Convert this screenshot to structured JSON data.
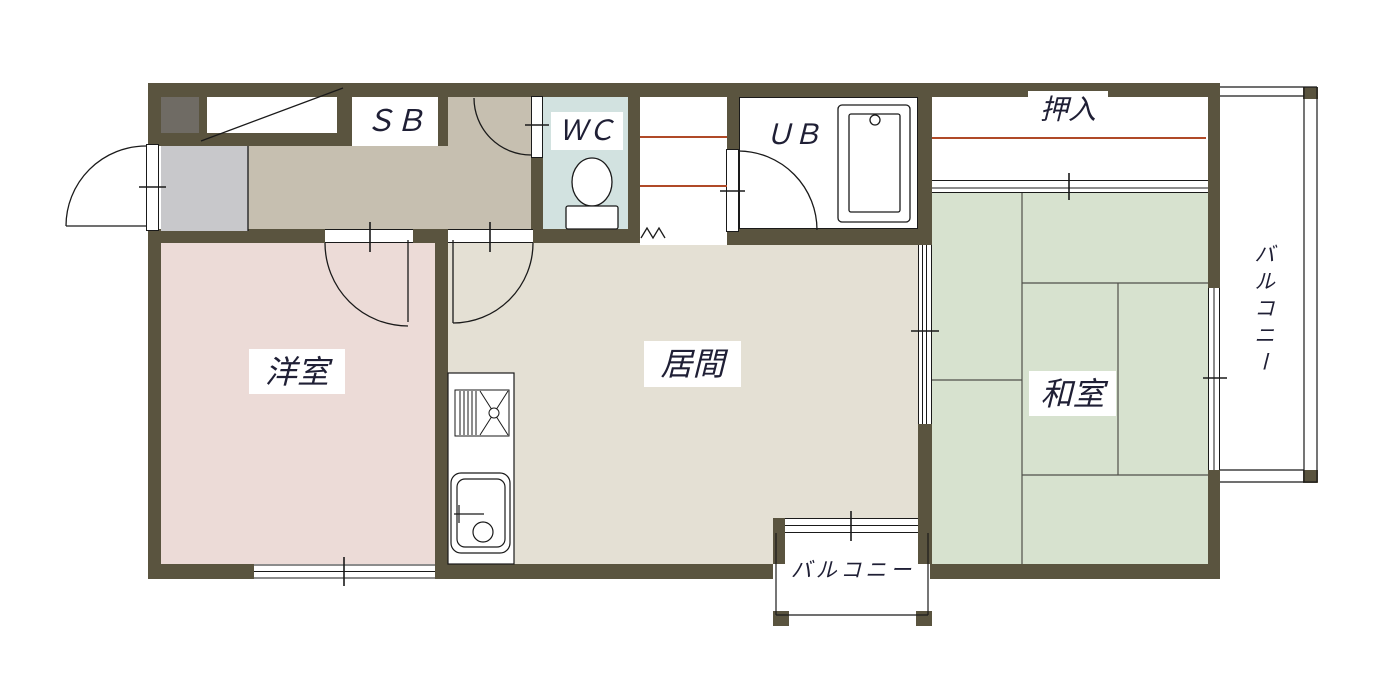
{
  "floorplan": {
    "kind": "japanese-apartment-floor-plan",
    "labels": {
      "shoe_box": "ＳＢ",
      "toilet": "ＷＣ",
      "unit_bath": "ＵＢ",
      "closet": "押入",
      "western_room": "洋室",
      "living_room": "居間",
      "japanese_room": "和室",
      "balcony_right": "バルコニー",
      "balcony_bottom": "バルコニー"
    },
    "colors": {
      "wall": "#5a543f",
      "hallway_floor": "#c6bfb0",
      "entrance_floor": "#c8c8cb",
      "western_room_floor": "#ecdbd7",
      "living_room_floor": "#e4e0d4",
      "japanese_room_floor": "#d7e2cf",
      "toilet_floor": "#d2e2e0",
      "bath_floor": "#ffffff",
      "shelf_line": "#b04a28",
      "meter_box": "#6f6b64",
      "text": "#1f1f35"
    }
  }
}
